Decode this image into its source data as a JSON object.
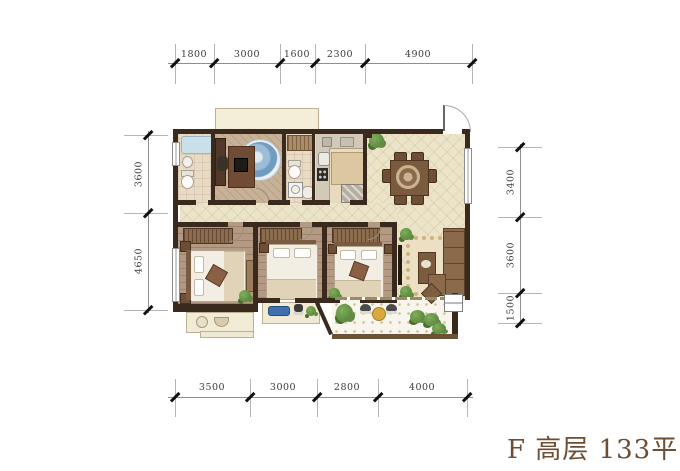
{
  "title": {
    "text": "F 高层 133平",
    "color": "#6d4d33"
  },
  "dimensions": {
    "top": [
      "1800",
      "3000",
      "1600",
      "2300",
      "4900"
    ],
    "bottom": [
      "3500",
      "3000",
      "2800",
      "4000"
    ],
    "left": [
      "3600",
      "4650"
    ],
    "right": [
      "3400",
      "3600",
      "1500"
    ]
  },
  "colors": {
    "wall": "#3a2a1e",
    "living_dining_floor": "#ece4c8",
    "bedroom_floor": "#b49a82",
    "balcony_tile": "#f8f5ed",
    "bathtub_blue": "#c9dfe9",
    "study_rug_blue": "#7da7c4",
    "title_brown": "#6d4d33"
  }
}
